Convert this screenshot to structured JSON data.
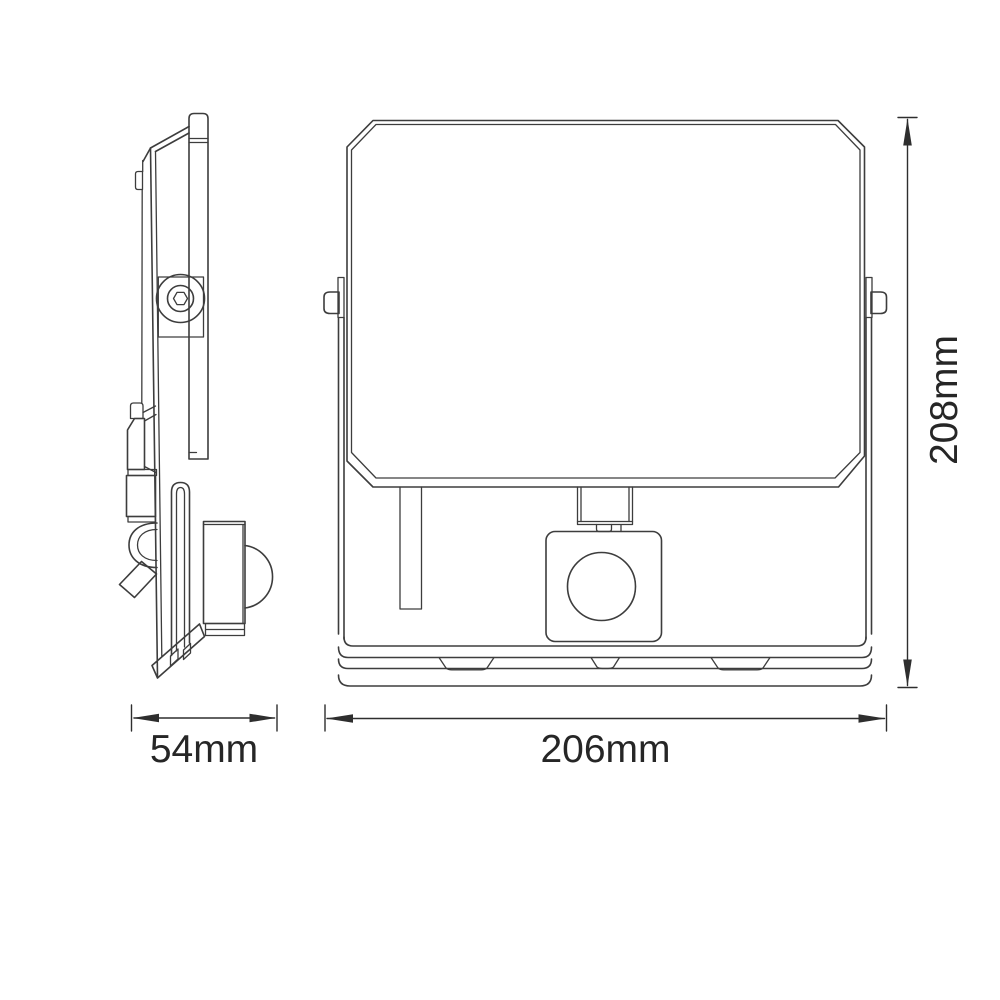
{
  "dimensions": {
    "side_width": {
      "label": "54mm"
    },
    "front_width": {
      "label": "206mm"
    },
    "front_height": {
      "label": "208mm"
    }
  },
  "colors": {
    "line": "#3d3d3d",
    "dimension_line": "#2e2e2e",
    "text": "#262626",
    "background": "#ffffff"
  }
}
